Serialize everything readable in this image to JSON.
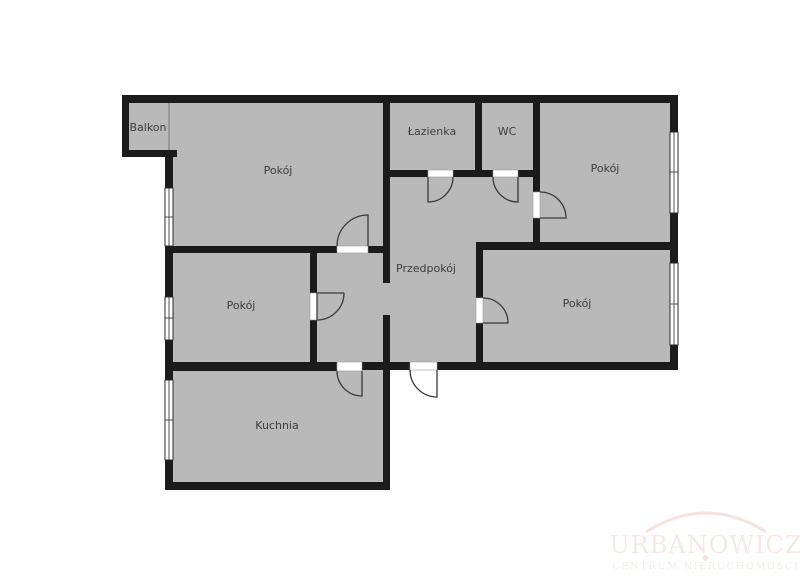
{
  "colors": {
    "background": "#ffffff",
    "floor": "#b9b9b9",
    "wall": "#1b1b1b",
    "label": "#3d3d3d",
    "doorline": "#3a3a3a",
    "windowline": "#2b2b2b",
    "watermark": "#f8e8e5",
    "watermark-arc": "#f6e1dd"
  },
  "rooms": [
    {
      "id": "balkon",
      "label": "Balkon"
    },
    {
      "id": "pokoj-top-left",
      "label": "Pokój"
    },
    {
      "id": "lazienka",
      "label": "Łazienka"
    },
    {
      "id": "wc",
      "label": "WC"
    },
    {
      "id": "pokoj-top-right",
      "label": "Pokój"
    },
    {
      "id": "pokoj-middle-left",
      "label": "Pokój"
    },
    {
      "id": "przedpokoj",
      "label": "Przedpokój"
    },
    {
      "id": "pokoj-bottom-right",
      "label": "Pokój"
    },
    {
      "id": "kuchnia",
      "label": "Kuchnia"
    }
  ],
  "watermark": {
    "title": "URBANOWICZ",
    "subtitle": "CENTRUM NIERUCHOMOŚCI"
  }
}
